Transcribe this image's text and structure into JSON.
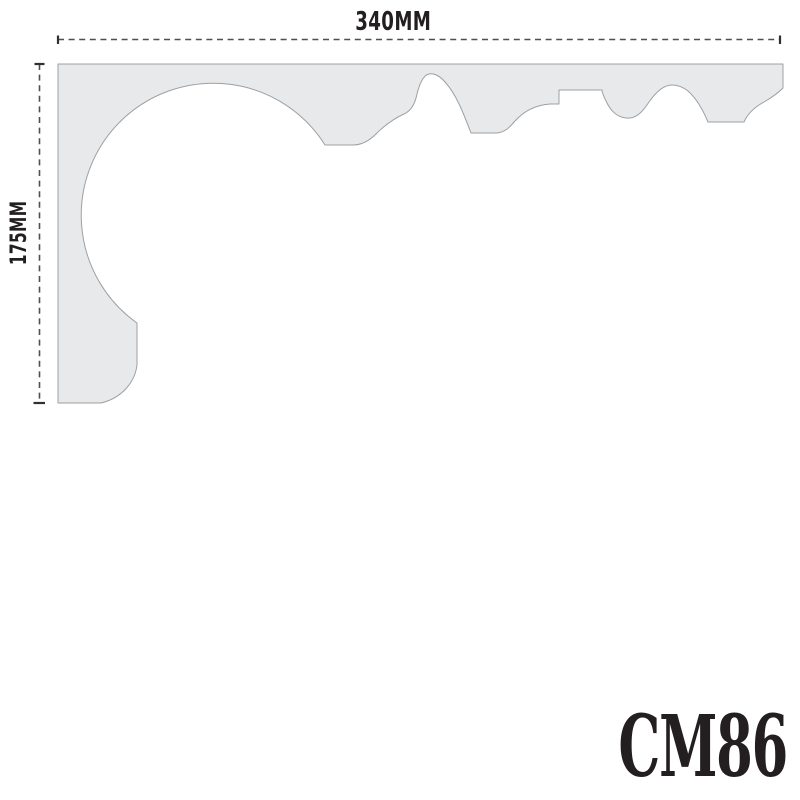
{
  "page": {
    "background_color": "#ffffff"
  },
  "drawing": {
    "product_code": "CM86",
    "dimensions": {
      "width_label": "340MM",
      "width_mm": 340,
      "height_label": "175MM",
      "height_mm": 175
    },
    "profile": {
      "description": "cornice-coving-cross-section",
      "path": "M 58 64 L 783 64 L 783 88 C 778 93 771 98 764 102 C 753 108 747 115 744 122 L 708 122 C 703 110 697 99 688 91 C 683 87 677 85 672 85 C 664 85 656 92 649 102 C 643 111 638 117 630 118 C 619 119 611 112 606 101 C 603 95 602 92 602 90 L 559 90 L 559 104 L 550 104 C 536 105 524 111 515 121 C 509 128 505 132 497 133 L 471 133 C 463 112 456 94 445 82 C 440 76 434 73 429 74 C 424 75 420 82 417 94 C 415 104 411 111 404 114 C 393 119 384 126 376 134 C 369 141 362 145 353 145 L 325 145 A 132 132 0 1 0 137 323 L 137 365 C 135 382 122 398 101 403 L 58 403 Z",
      "fill_color": "#e8e9ea",
      "outline_color": "#9da0a3"
    },
    "dimension_line_color": "#4f4f4f",
    "tick_color": "#303030",
    "text_color": "#231f20"
  }
}
